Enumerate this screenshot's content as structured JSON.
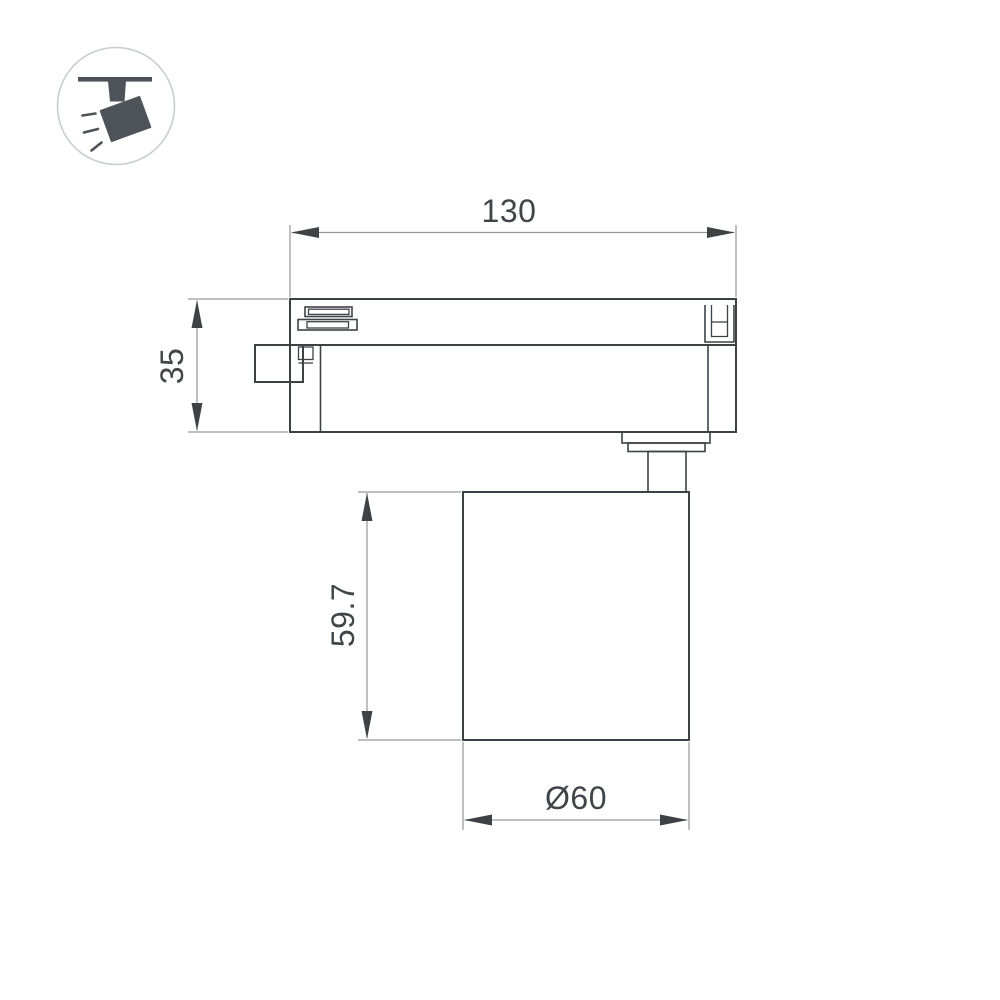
{
  "colors": {
    "background": "#ffffff",
    "part_line": "#3e4245",
    "dimension_line": "#939699",
    "text": "#414548",
    "icon_fill": "#4d5359",
    "icon_circle_stroke": "#c9cdce"
  },
  "icon": {
    "name": "track-spotlight-icon"
  },
  "dimensions": {
    "overall_width": "130",
    "adapter_height": "35",
    "head_height": "59.7",
    "head_diameter": "Ø60"
  }
}
